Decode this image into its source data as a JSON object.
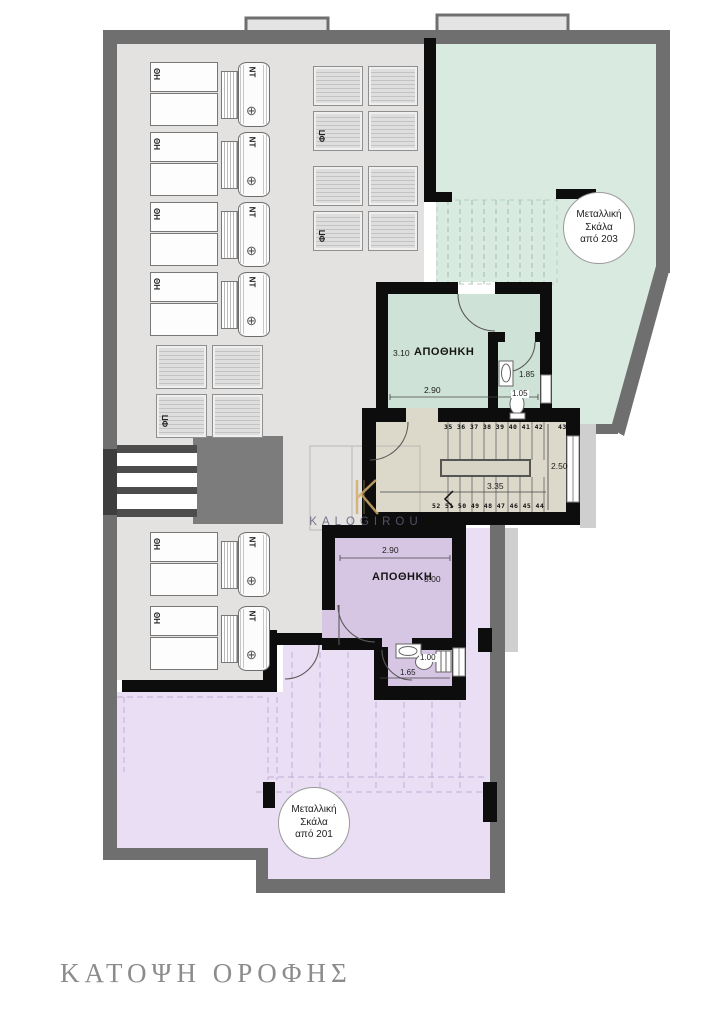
{
  "page": {
    "title": "ΚΑΤΟΨΗ ΟΡΟΦΗΣ"
  },
  "watermark": {
    "brand": "KALOGIROU"
  },
  "equipment": {
    "solar_heater_label": "ΗΘ",
    "tank_label": "ΝΤ",
    "pv_label": "ΦΠ"
  },
  "rooms": {
    "storage_upper": {
      "name": "ΑΠΟΘΗΚΗ",
      "depth": "3.10",
      "width": "2.90"
    },
    "wc_upper": {
      "dim1": "1.85",
      "dim2": "1.05"
    },
    "storage_lower": {
      "name": "ΑΠΟΘΗΚΗ",
      "depth": "3.00",
      "width": "2.90"
    },
    "wc_lower": {
      "dim1": "1.00",
      "dim2": "1.65"
    }
  },
  "stairs": {
    "upper_run_numbers": "35 36 37 38 39 40 41 42",
    "upper_last_number": "43",
    "lower_run_numbers": "52 51 50 49 48 47 46 45 44",
    "width_label": "3.35",
    "depth_label": "2.50"
  },
  "annotations": {
    "metal_stair_203": [
      "Μεταλλική",
      "Σκάλα",
      "από 203"
    ],
    "metal_stair_201": [
      "Μεταλλική",
      "Σκάλα",
      "από 201"
    ]
  },
  "colors": {
    "wall-gray": "#6f6f6f",
    "roof-gray": "#e3e2e1",
    "terrace-green": "#d9eae1",
    "room-green": "#cfe2d7",
    "stair-beige": "#dcd9ca",
    "room-purple": "#d6c6e3",
    "terrace-lavender": "#e9def4",
    "wall-black": "#0d0d0d",
    "brand-gold": "#d2ad6a",
    "brand-ink": "#5f5f78",
    "title-gray": "#8c8c8c"
  }
}
